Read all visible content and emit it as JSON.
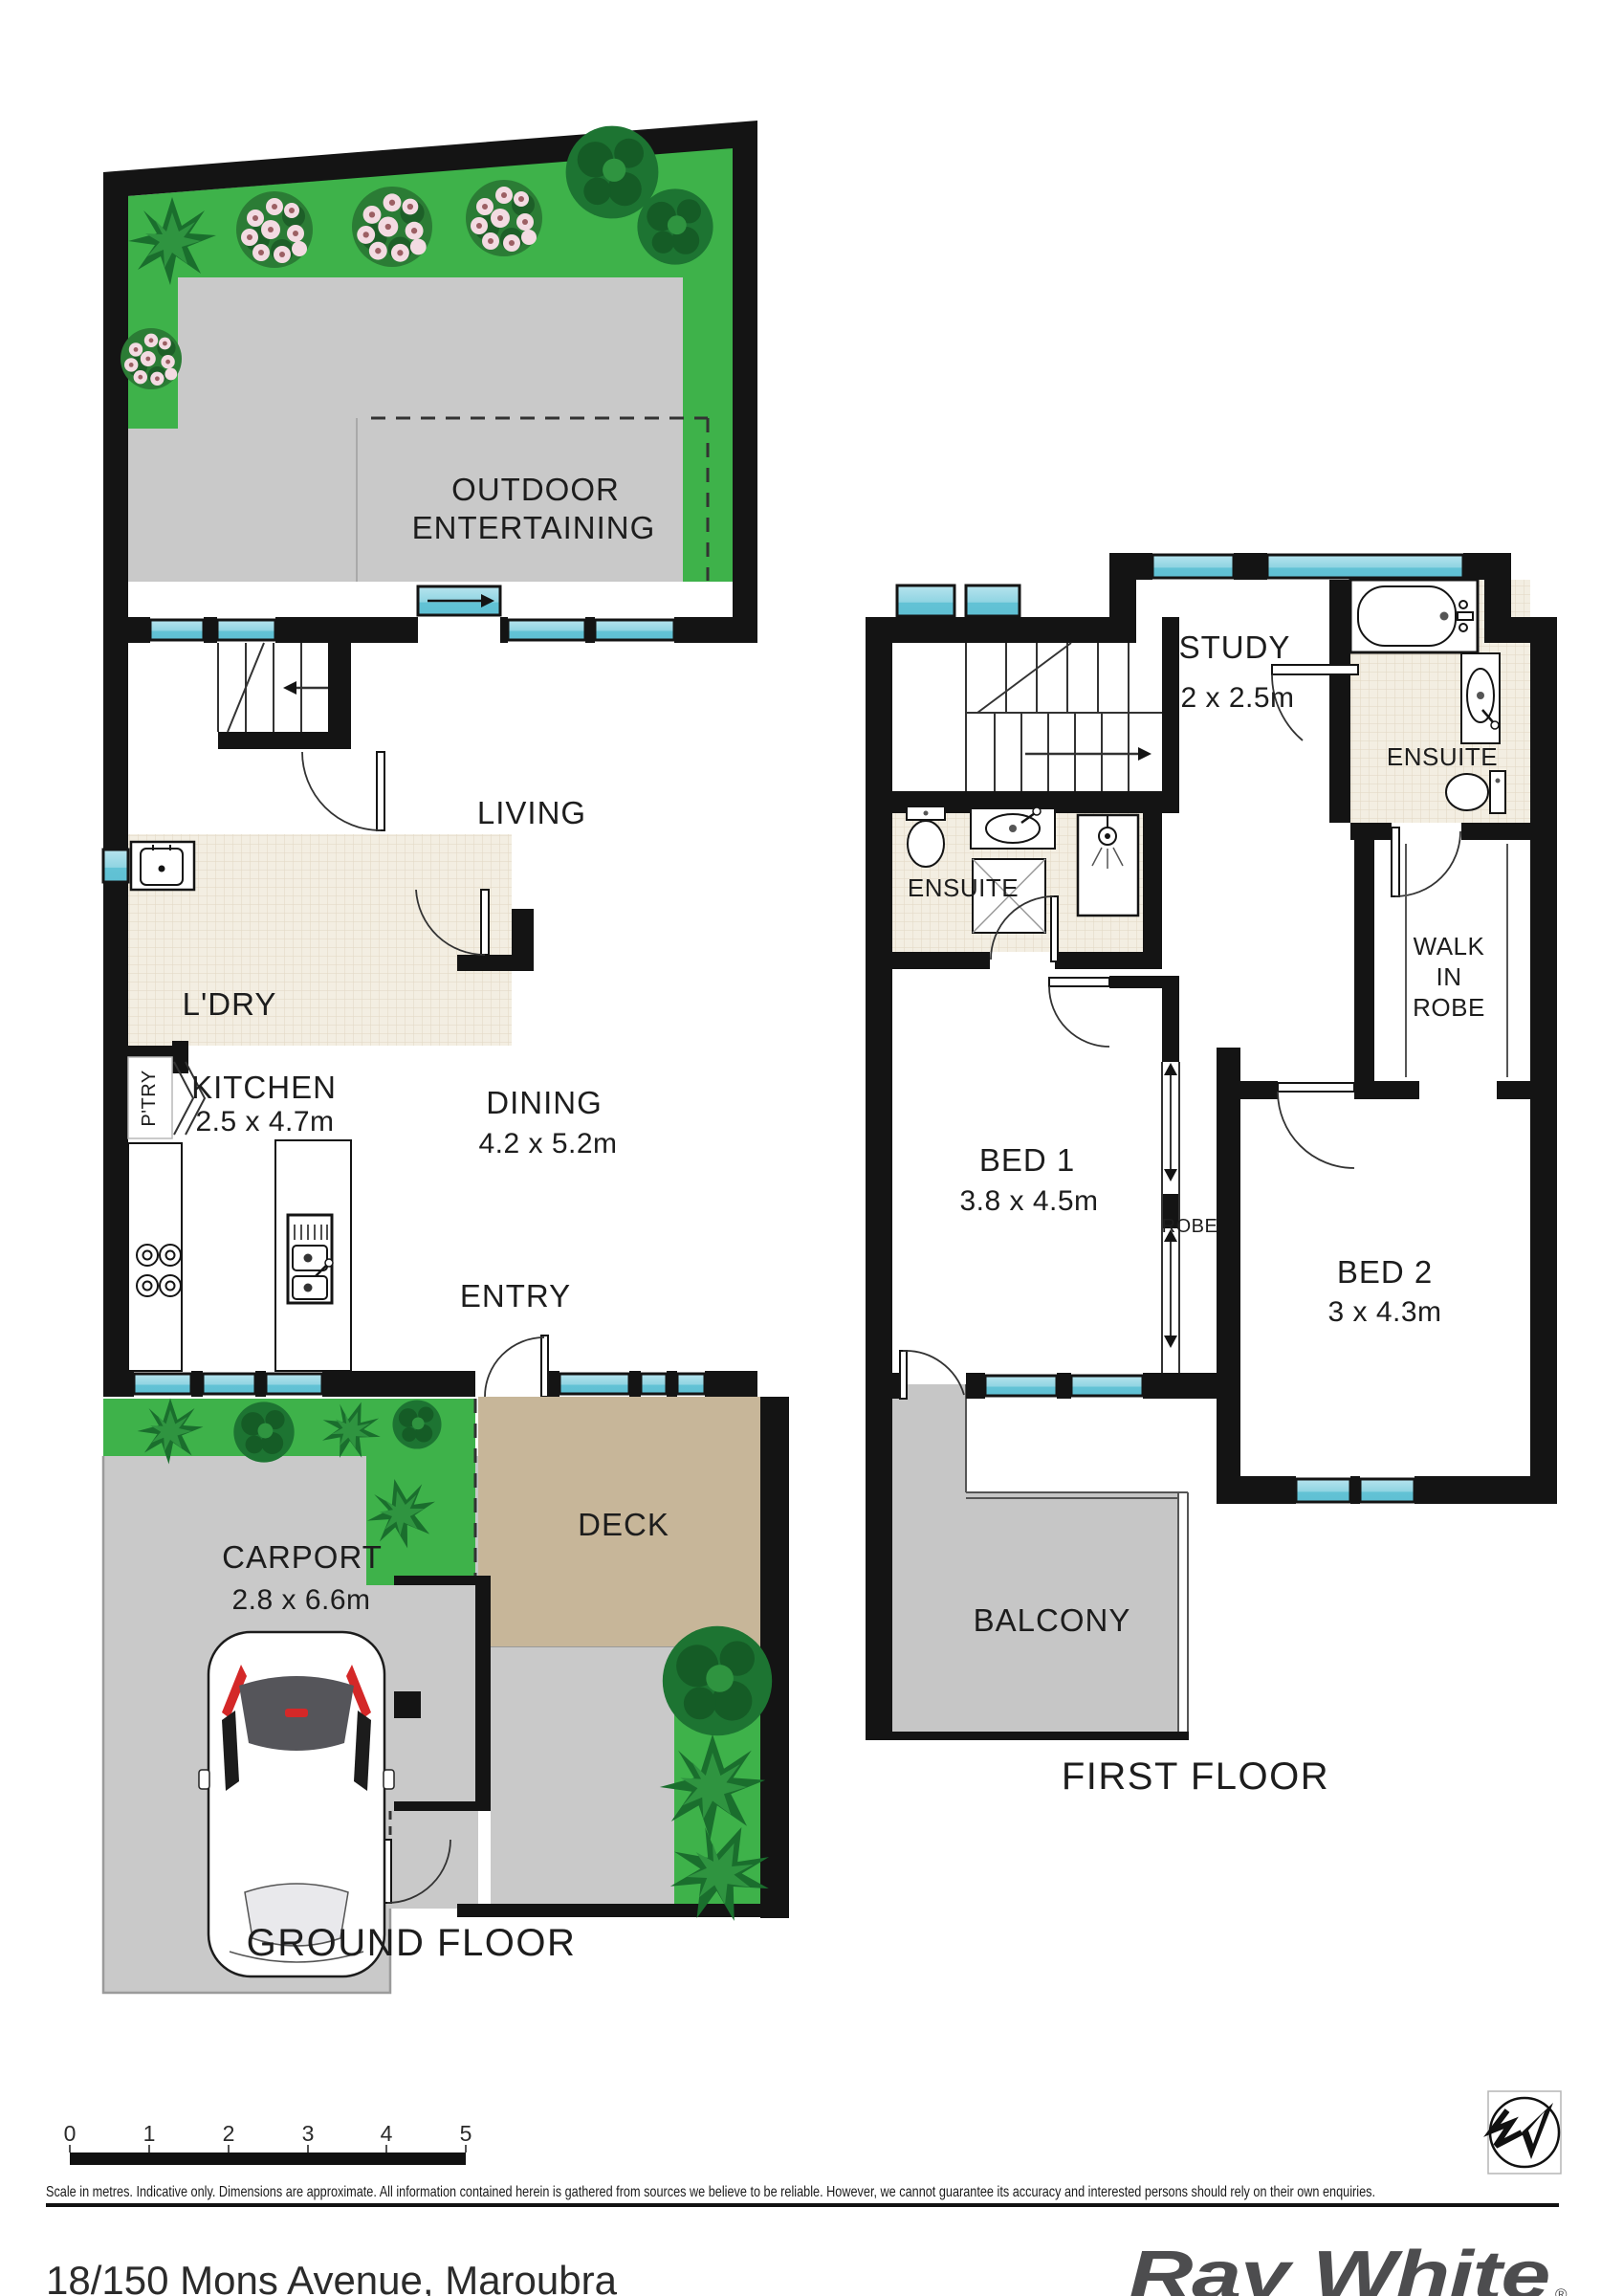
{
  "ground_floor": {
    "title": "GROUND FLOOR",
    "outdoor_line1": "OUTDOOR",
    "outdoor_line2": "ENTERTAINING",
    "living": "LIVING",
    "ldry": "L'DRY",
    "ptry": "P'TRY",
    "kitchen_name": "KITCHEN",
    "kitchen_dims": "2.5 x 4.7m",
    "dining_name": "DINING",
    "dining_dims": "4.2 x 5.2m",
    "entry": "ENTRY",
    "deck": "DECK",
    "carport_name": "CARPORT",
    "carport_dims": "2.8 x 6.6m"
  },
  "first_floor": {
    "title": "FIRST FLOOR",
    "study_name": "STUDY",
    "study_dims": "2 x 2.5m",
    "ensuite_top": "ENSUITE",
    "ensuite_left": "ENSUITE",
    "wir_line1": "WALK",
    "wir_line2": "IN",
    "wir_line3": "ROBE",
    "bed1_name": "BED 1",
    "bed1_dims": "3.8 x 4.5m",
    "robe": "ROBE",
    "bed2_name": "BED 2",
    "bed2_dims": "3 x 4.3m",
    "balcony": "BALCONY"
  },
  "scale": {
    "ticks": [
      "0",
      "1",
      "2",
      "3",
      "4",
      "5"
    ],
    "caption": "Scale in metres. Indicative only. Dimensions are approximate. All information contained herein is gathered from sources we believe to be reliable. However, we cannot guarantee its accuracy and interested persons should rely on their own enquiries."
  },
  "footer": {
    "address": "18/150 Mons Avenue, Maroubra",
    "brand": "Ray White",
    "registered": "®"
  },
  "colors": {
    "wall": "#141414",
    "lawn": "#3eb24a",
    "paving": "#c9c9c9",
    "deck": "#c7b699",
    "window_top": "#b7e4ee",
    "window_bottom": "#5fc0d4",
    "tile": "#f3eee2",
    "brand_gray": "#4d4d4f",
    "accent_red": "#d42828"
  }
}
